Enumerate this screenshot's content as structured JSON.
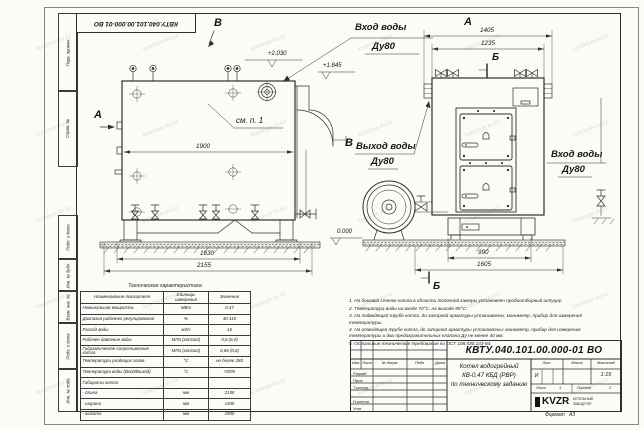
{
  "watermark": {
    "text": "kotelnye-kv.kz"
  },
  "stamp_top": {
    "doc_number": "КВТУ.040.101.00.000-01  ВО"
  },
  "sidebar": {
    "labels": [
      "Перв. примен.",
      "Справ. №",
      "Подп. и дата",
      "Инв. № дубл.",
      "Взам. инв. №",
      "Подп. и дата",
      "Инв. № подл."
    ]
  },
  "main_view": {
    "label_a": "А",
    "label_v_top": "В",
    "label_v_right": "В",
    "see_note": "см. п. 1",
    "inlet_label": "Вход воды",
    "inlet_dn": "Ду80",
    "elev_top": "+2.030",
    "elev_mid": "+1.845",
    "elev_zero": "0.000",
    "dim_inner_width": "1900",
    "dim_base": "1630",
    "dim_overall": "2155"
  },
  "front_view": {
    "label_a": "А",
    "label_b_top": "Б",
    "label_b_bottom": "Б",
    "dim_width_overall": "1405",
    "dim_width_body": "1235",
    "dim_base": "990",
    "dim_overall": "1605",
    "outlet_label": "Выход воды",
    "outlet_dn": "Ду80",
    "inlet_label": "Вход воды",
    "inlet_dn": "Ду80"
  },
  "spec_table": {
    "title": "Техническая характеристика",
    "headers": [
      "Наименование показателя",
      "Единицы измерения",
      "Значение"
    ],
    "rows": [
      [
        "Номинальная мощность",
        "МВт",
        "0,47"
      ],
      [
        "Диапазон рабочего регулирования",
        "%",
        "40-110"
      ],
      [
        "Расход воды",
        "м3/ч",
        "16"
      ],
      [
        "Рабочее давление воды",
        "МПа (кгс/см2)",
        "0,6 (6,0)"
      ],
      [
        "Гидравлическое сопротивление котла",
        "МПа (кгс/см2)",
        "0,06 (0,6)"
      ],
      [
        "Температура уходящих газов",
        "°С",
        "не более 280"
      ],
      [
        "Температура воды (Вход/Выход)",
        "°С",
        "70/95"
      ],
      [
        "Габариты котла",
        "",
        ""
      ],
      [
        "   - длина",
        "мм",
        "2155"
      ],
      [
        "   - ширина",
        "мм",
        "1405"
      ],
      [
        "   - высота",
        "мм",
        "1900"
      ]
    ]
  },
  "notes": {
    "items": [
      "1. На боковой стенке котла в области топочной камеры установлен пробоотборный штуцер",
      "2. Температура воды на входе 70°С, на выходе 95°С.",
      "3. На подводящей трубе котла, до запорной арматуры установлены: манометр, прибор для измерения температуры.",
      "4. На отводящей трубе котла, до запорной арматуры установлены: манометр, прибор для измерения температуры и два предохранительных клапана Ду не менее 40 мм.",
      "5. Остальные технические требования по ОСТ 108.030.133-84."
    ]
  },
  "title_block": {
    "doc_number": "КВТУ.040.101.00.000-01  ВО",
    "title_line1": "Котел водогрейный",
    "title_line2": "КВ-0,47 КБД (РВР)",
    "title_line3": "по техническому заданию",
    "col_headers": [
      "Изм.",
      "Лист",
      "№ докум.",
      "Подп.",
      "Дата"
    ],
    "row_labels": [
      "Разраб.",
      "Пров.",
      "Т.контр.",
      "",
      "Н.контр.",
      "Утв."
    ],
    "lit_header": "Лит.",
    "mass_header": "Масса",
    "scale_header": "Масштаб",
    "lit_value": "И",
    "scale_value": "1:15",
    "sheet_label": "Лист",
    "sheet_value": "1",
    "sheets_label": "Листов",
    "sheets_value": "2",
    "logo_text": "KVZR",
    "logo_sub1": "КОТЕЛЬНЫЙ",
    "logo_sub2": "ЗАВОД РЭП",
    "format_label": "Формат",
    "format_value": "А3"
  }
}
